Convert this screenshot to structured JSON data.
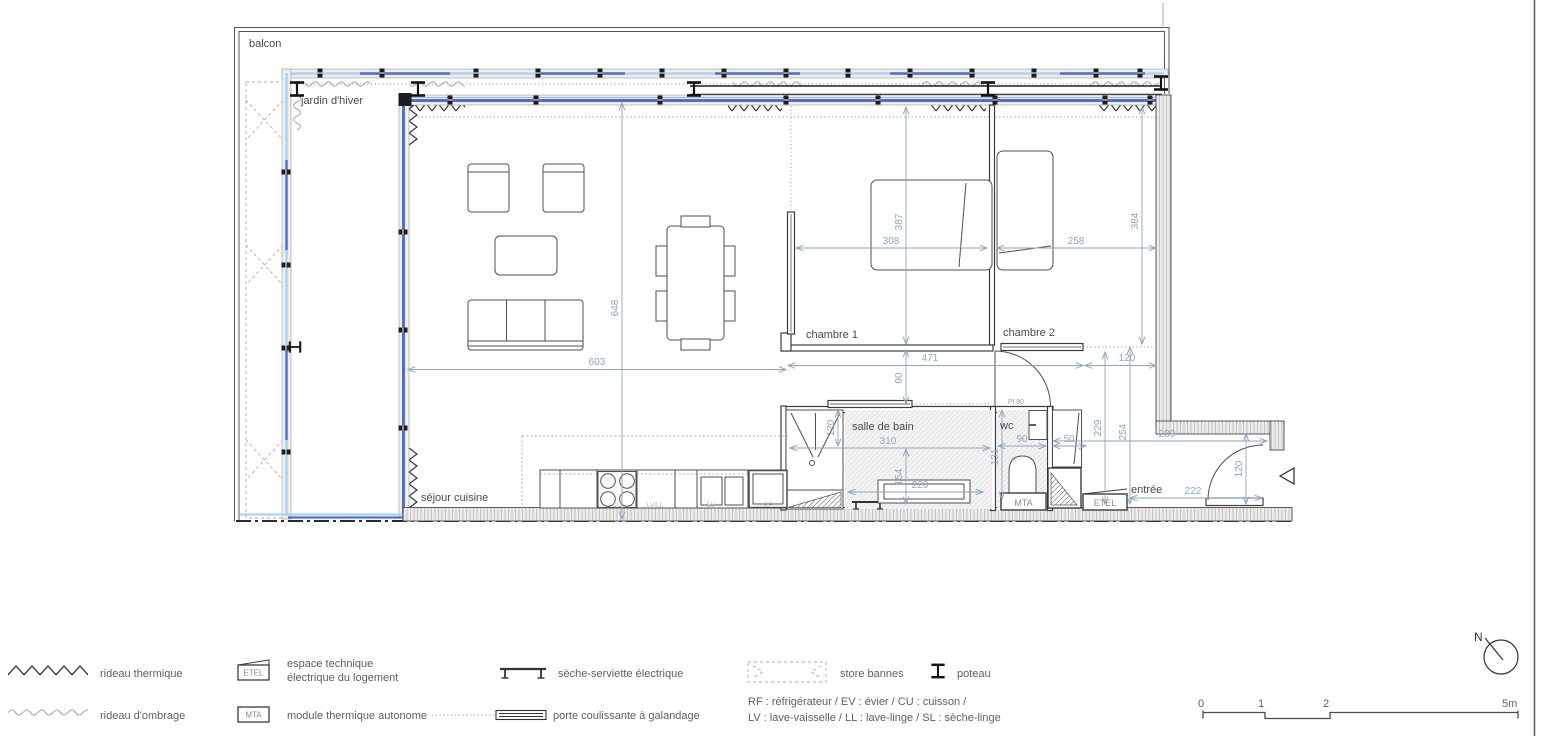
{
  "colors": {
    "dimension": "#8da6bc",
    "glazing_light": "#a9d3f0",
    "glazing_dark": "#4f6fd0",
    "wall": "#3c3c3c"
  },
  "plan": {
    "rooms": {
      "balcon": "balcon",
      "jardin": "jardin d'hiver",
      "sejour": "séjour cuisine",
      "chambre1": "chambre 1",
      "chambre2": "chambre 2",
      "sdb": "salle de bain",
      "wc": "wc",
      "entree": "entrée"
    },
    "labels": {
      "pl80": "Pl 80",
      "cu": "CU",
      "lvll": "LV/LL",
      "ev": "EV",
      "rf": "RF",
      "mta": "MTA",
      "etel": "ETEL"
    },
    "dims": {
      "sejour_w": "603",
      "sejour_d": "648",
      "ch1_w": "308",
      "ch1_d": "387",
      "ch2_w": "258",
      "right_d": "384",
      "hall_w": "471",
      "hall_e": "120",
      "corridor": "90",
      "sdb_w": "310",
      "sdb_door": "120",
      "sdb_d": "154",
      "vanity_w": "220",
      "wc_w": "90",
      "wc_d": "131",
      "shaft_w": "50",
      "entry_d1": "229",
      "entry_d2": "254",
      "entry_w": "289",
      "entry_door_w": "222",
      "entry_clear": "120"
    }
  },
  "legend": {
    "rideau_thermique": "rideau thermique",
    "rideau_ombrage": "rideau d'ombrage",
    "etel_tag": "ETEL",
    "etel_line1": "espace technique",
    "etel_line2": "électrique du logement",
    "mta_tag": "MTA",
    "mta_desc": "module thermique autonome",
    "seche_serviette": "sèche-serviette électrique",
    "porte_coulissante": "porte coulissante à galandage",
    "store_bannes": "store bannes",
    "poteau": "poteau",
    "abbrev_line1": "RF : réfrigérateur / EV : évier / CU : cuisson /",
    "abbrev_line2": "LV : lave-vaisselle / LL : lave-linge / SL : sèche-linge"
  },
  "scale_bar": {
    "t0": "0",
    "t1": "1",
    "t2": "2",
    "t5": "5m"
  },
  "north_label": "N"
}
